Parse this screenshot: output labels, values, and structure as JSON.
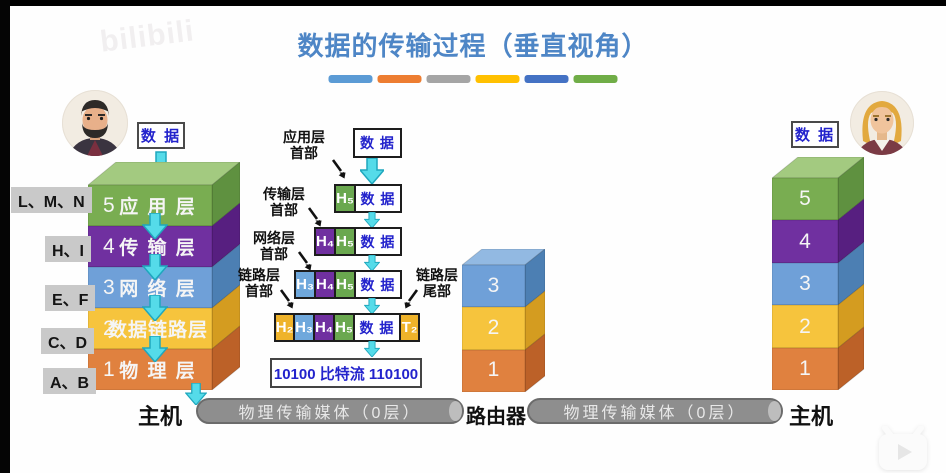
{
  "watermark": "bilibili",
  "title": "数据的传输过程（垂直视角）",
  "title_bars": [
    "#5b9bd5",
    "#ed7d31",
    "#a5a5a5",
    "#ffc000",
    "#4472c4",
    "#70ad47"
  ],
  "colors": {
    "title_text": "#4e86c6",
    "data_text": "#2323cc",
    "arrow_cyan": "#55dbe9",
    "pipe_gray": "#8e8e8e"
  },
  "left_host": {
    "data_label": "数 据",
    "caption": "主机",
    "tags": [
      "L、M、N",
      "H、I",
      "E、F",
      "C、D",
      "A、B"
    ],
    "layers": [
      {
        "num": "5",
        "name": "应 用 层",
        "color": "#79ad51"
      },
      {
        "num": "4",
        "name": "传 输 层",
        "color": "#7030a0"
      },
      {
        "num": "3",
        "name": "网 络 层",
        "color": "#6fa0d8"
      },
      {
        "num": "2",
        "name": "数据链路层",
        "color": "#f6c43d"
      },
      {
        "num": "1",
        "name": "物 理 层",
        "color": "#e0813f"
      }
    ]
  },
  "encapsulation": {
    "top_box": "数 据",
    "labels": {
      "app": {
        "line1": "应用层",
        "line2": "首部"
      },
      "transport": {
        "line1": "传输层",
        "line2": "首部"
      },
      "network": {
        "line1": "网络层",
        "line2": "首部"
      },
      "link": {
        "line1": "链路层",
        "line2": "首部"
      },
      "trailer": {
        "line1": "链路层",
        "line2": "尾部"
      }
    },
    "rows": [
      {
        "cells": [
          {
            "text": "H₅"
          },
          {
            "text": "数 据"
          }
        ]
      },
      {
        "cells": [
          {
            "text": "H₄"
          },
          {
            "text": "H₅"
          },
          {
            "text": "数 据"
          }
        ]
      },
      {
        "cells": [
          {
            "text": "H₃"
          },
          {
            "text": "H₄"
          },
          {
            "text": "H₅"
          },
          {
            "text": "数 据"
          }
        ]
      },
      {
        "cells": [
          {
            "text": "H₂"
          },
          {
            "text": "H₃"
          },
          {
            "text": "H₄"
          },
          {
            "text": "H₅"
          },
          {
            "text": "数 据"
          },
          {
            "text": "T₂"
          }
        ]
      }
    ],
    "bitstream": "10100 比特流 110100"
  },
  "router": {
    "caption": "路由器",
    "layers": [
      "3",
      "2",
      "1"
    ]
  },
  "right_host": {
    "data_label": "数 据",
    "caption": "主机",
    "layers": [
      "5",
      "4",
      "3",
      "2",
      "1"
    ]
  },
  "media": {
    "left_label": "物理传输媒体（0层）",
    "right_label": "物理传输媒体（0层）"
  }
}
